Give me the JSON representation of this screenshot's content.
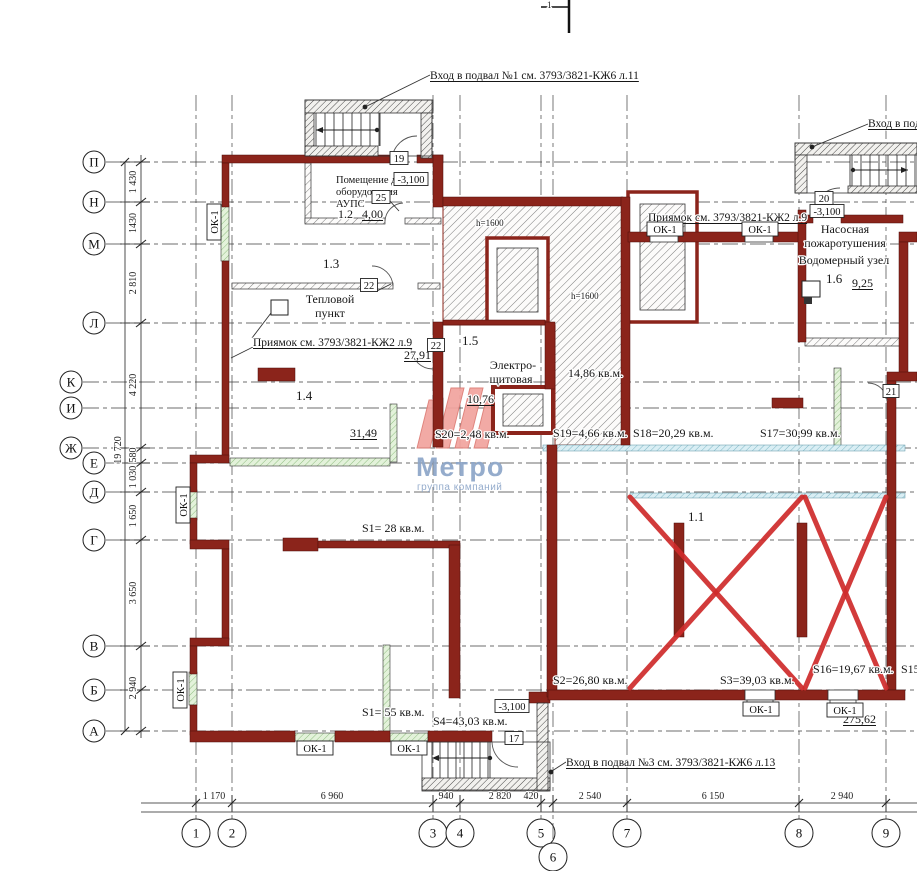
{
  "title": "Floor plan — basement (подвал), blueprint 3793/3821",
  "colors": {
    "wall": "#8b241b",
    "cross": "#cf2b2b",
    "logopink": "#f2a49f",
    "logopinkedge": "#dd7b74",
    "logoblue": "#8da6c9",
    "greenfill": "#e3f2da",
    "cyanfill": "#d9eef4",
    "paper": "#ffffff"
  },
  "logo": {
    "brand": "Метро",
    "tagline": "группа компаний"
  },
  "section_mark": {
    "label": "1"
  },
  "grid": {
    "rows": [
      {
        "label": "П",
        "y": 162,
        "bx": 94
      },
      {
        "label": "Н",
        "y": 202,
        "bx": 94
      },
      {
        "label": "М",
        "y": 244,
        "bx": 94
      },
      {
        "label": "Л",
        "y": 323,
        "bx": 94
      },
      {
        "label": "К",
        "y": 382,
        "bx": 71
      },
      {
        "label": "И",
        "y": 408,
        "bx": 71
      },
      {
        "label": "Ж",
        "y": 448,
        "bx": 71
      },
      {
        "label": "Е",
        "y": 463,
        "bx": 94
      },
      {
        "label": "Д",
        "y": 492,
        "bx": 94
      },
      {
        "label": "Г",
        "y": 540,
        "bx": 94
      },
      {
        "label": "В",
        "y": 646,
        "bx": 94
      },
      {
        "label": "Б",
        "y": 690,
        "bx": 94
      },
      {
        "label": "А",
        "y": 731,
        "bx": 94
      }
    ],
    "cols": [
      {
        "label": "1",
        "x": 196,
        "by": 833
      },
      {
        "label": "2",
        "x": 232,
        "by": 833
      },
      {
        "label": "3",
        "x": 433,
        "by": 833
      },
      {
        "label": "4",
        "x": 460,
        "by": 833
      },
      {
        "label": "5",
        "x": 541,
        "by": 833
      },
      {
        "label": "6",
        "x": 553,
        "by": 857
      },
      {
        "label": "7",
        "x": 627,
        "by": 833
      },
      {
        "label": "8",
        "x": 799,
        "by": 833
      },
      {
        "label": "9",
        "x": 886,
        "by": 833
      }
    ]
  },
  "dims": {
    "left": [
      {
        "v": "1 430",
        "y": 182
      },
      {
        "v": "1430",
        "y": 223
      },
      {
        "v": "2 810",
        "y": 283
      },
      {
        "v": "4 220",
        "y": 385
      },
      {
        "v": "580",
        "y": 455
      },
      {
        "v": "1 030",
        "y": 477
      },
      {
        "v": "1 650",
        "y": 516
      },
      {
        "v": "3 650",
        "y": 593
      },
      {
        "v": "2 940",
        "y": 688
      }
    ],
    "left_overall": {
      "v": "19 720",
      "y": 450
    },
    "bottom": [
      {
        "v": "1 170",
        "cx": 214
      },
      {
        "v": "6 960",
        "cx": 332
      },
      {
        "v": "940",
        "cx": 446
      },
      {
        "v": "2 820",
        "cx": 500
      },
      {
        "v": "420",
        "cx": 531
      },
      {
        "v": "2 540",
        "cx": 590
      },
      {
        "v": "6 150",
        "cx": 713
      },
      {
        "v": "2 940",
        "cx": 842
      }
    ]
  },
  "texts": [
    {
      "t": "Вход в подвал №1 см. 3793/3821-КЖ6 л.11",
      "x": 430,
      "y": 79,
      "s": 11.5,
      "u": 1
    },
    {
      "t": "Вход в под",
      "x": 868,
      "y": 127,
      "s": 11.5,
      "u": 1
    },
    {
      "t": "Вход в подвал №3 см. 3793/3821-КЖ6 л.13",
      "x": 566,
      "y": 766,
      "s": 11.5,
      "u": 1
    },
    {
      "t": "Приямок см. 3793/3821-КЖ2 л.9",
      "x": 253,
      "y": 346,
      "s": 11.5,
      "u": 1
    },
    {
      "t": "Приямок см. 3793/3821-КЖ2 л.9",
      "x": 648,
      "y": 221,
      "s": 11.5,
      "u": 1
    },
    {
      "t": "Помещение для",
      "x": 336,
      "y": 183,
      "s": 10.5
    },
    {
      "t": "оборудования",
      "x": 336,
      "y": 195,
      "s": 10.5
    },
    {
      "t": "АУПС",
      "x": 336,
      "y": 207,
      "s": 10.5
    },
    {
      "t": "1.2",
      "x": 338,
      "y": 218,
      "s": 12
    },
    {
      "t": "4,00",
      "x": 362,
      "y": 218,
      "s": 12,
      "u": 1
    },
    {
      "t": "1.3",
      "x": 323,
      "y": 268,
      "s": 13
    },
    {
      "t": "Тепловой",
      "x": 330,
      "y": 303,
      "s": 12,
      "a": "middle"
    },
    {
      "t": "пункт",
      "x": 330,
      "y": 317,
      "s": 12,
      "a": "middle"
    },
    {
      "t": "27,91",
      "x": 404,
      "y": 359,
      "s": 12,
      "u": 1
    },
    {
      "t": "1.4",
      "x": 296,
      "y": 400,
      "s": 13
    },
    {
      "t": "31,49",
      "x": 350,
      "y": 437,
      "s": 12,
      "u": 1
    },
    {
      "t": "1.5",
      "x": 462,
      "y": 345,
      "s": 13
    },
    {
      "t": "Электро-",
      "x": 513,
      "y": 369,
      "s": 12,
      "a": "middle"
    },
    {
      "t": "щитовая",
      "x": 511,
      "y": 383,
      "s": 12,
      "a": "middle"
    },
    {
      "t": "10,76",
      "x": 467,
      "y": 403,
      "s": 12,
      "u": 1
    },
    {
      "t": "14,86 кв.м.",
      "x": 568,
      "y": 377,
      "s": 12
    },
    {
      "t": "h=1600",
      "x": 476,
      "y": 226,
      "s": 9
    },
    {
      "t": "h=1600",
      "x": 571,
      "y": 299,
      "s": 9
    },
    {
      "t": "Насосная",
      "x": 845,
      "y": 233,
      "s": 12,
      "a": "middle"
    },
    {
      "t": "пожаротушения",
      "x": 845,
      "y": 247,
      "s": 12,
      "a": "middle"
    },
    {
      "t": "Водомерный узел",
      "x": 844,
      "y": 264,
      "s": 12,
      "a": "middle"
    },
    {
      "t": "1.6",
      "x": 826,
      "y": 283,
      "s": 13
    },
    {
      "t": "9,25",
      "x": 852,
      "y": 287,
      "s": 12,
      "u": 1
    },
    {
      "t": "1.1",
      "x": 688,
      "y": 521,
      "s": 13
    },
    {
      "t": "S20=2,48 кв.м.",
      "x": 435,
      "y": 438,
      "s": 12
    },
    {
      "t": "S19=4,66 кв.м.",
      "x": 553,
      "y": 437,
      "s": 12
    },
    {
      "t": "S18=20,29 кв.м.",
      "x": 633,
      "y": 437,
      "s": 12
    },
    {
      "t": "S17=30,99 кв.м.",
      "x": 760,
      "y": 437,
      "s": 12
    },
    {
      "t": "S2=26,80 кв.м.",
      "x": 553,
      "y": 684,
      "s": 12
    },
    {
      "t": "S3=39,03 кв.м.",
      "x": 720,
      "y": 684,
      "s": 12
    },
    {
      "t": "S16=19,67 кв.м.",
      "x": 813,
      "y": 673,
      "s": 12
    },
    {
      "t": "S15",
      "x": 901,
      "y": 673,
      "s": 12
    },
    {
      "t": "S1=  28 кв.м.",
      "x": 362,
      "y": 532,
      "s": 12
    },
    {
      "t": "S1=  55 кв.м.",
      "x": 362,
      "y": 716,
      "s": 12
    },
    {
      "t": "S4=43,03 кв.м.",
      "x": 433,
      "y": 725,
      "s": 12
    },
    {
      "t": "275,62",
      "x": 843,
      "y": 723,
      "s": 12,
      "u": 1
    },
    {
      "t": "1",
      "x": 547,
      "y": 8,
      "s": 9
    }
  ],
  "tags": [
    {
      "t": "19",
      "cx": 399,
      "cy": 158,
      "w": 18,
      "h": 13
    },
    {
      "t": "25",
      "cx": 381,
      "cy": 197,
      "w": 18,
      "h": 13
    },
    {
      "t": "-3,100",
      "cx": 411,
      "cy": 179,
      "w": 34,
      "h": 13
    },
    {
      "t": "22",
      "cx": 369,
      "cy": 285,
      "w": 17,
      "h": 13
    },
    {
      "t": "22",
      "cx": 436,
      "cy": 345,
      "w": 17,
      "h": 13
    },
    {
      "t": "20",
      "cx": 824,
      "cy": 198,
      "w": 18,
      "h": 13
    },
    {
      "t": "-3,100",
      "cx": 827,
      "cy": 211,
      "w": 34,
      "h": 13
    },
    {
      "t": "21",
      "cx": 891,
      "cy": 391,
      "w": 16,
      "h": 13
    },
    {
      "t": "17",
      "cx": 514,
      "cy": 738,
      "w": 18,
      "h": 13
    },
    {
      "t": "-3,100",
      "cx": 512,
      "cy": 706,
      "w": 34,
      "h": 13
    },
    {
      "t": "ОК-1",
      "cx": 665,
      "cy": 229,
      "w": 36,
      "h": 14
    },
    {
      "t": "ОК-1",
      "cx": 760,
      "cy": 229,
      "w": 36,
      "h": 14
    },
    {
      "t": "ОК-1",
      "cx": 315,
      "cy": 748,
      "w": 36,
      "h": 14
    },
    {
      "t": "ОК-1",
      "cx": 409,
      "cy": 748,
      "w": 36,
      "h": 14
    },
    {
      "t": "ОК-1",
      "cx": 761,
      "cy": 709,
      "w": 36,
      "h": 14
    },
    {
      "t": "ОК-1",
      "cx": 845,
      "cy": 710,
      "w": 36,
      "h": 14
    },
    {
      "t": "ОК-1",
      "cx": 214,
      "cy": 222,
      "w": 36,
      "h": 14,
      "rot": -90
    },
    {
      "t": "ОК-1",
      "cx": 183,
      "cy": 505,
      "w": 36,
      "h": 14,
      "rot": -90
    },
    {
      "t": "ОК-1",
      "cx": 180,
      "cy": 690,
      "w": 36,
      "h": 14,
      "rot": -90
    }
  ]
}
